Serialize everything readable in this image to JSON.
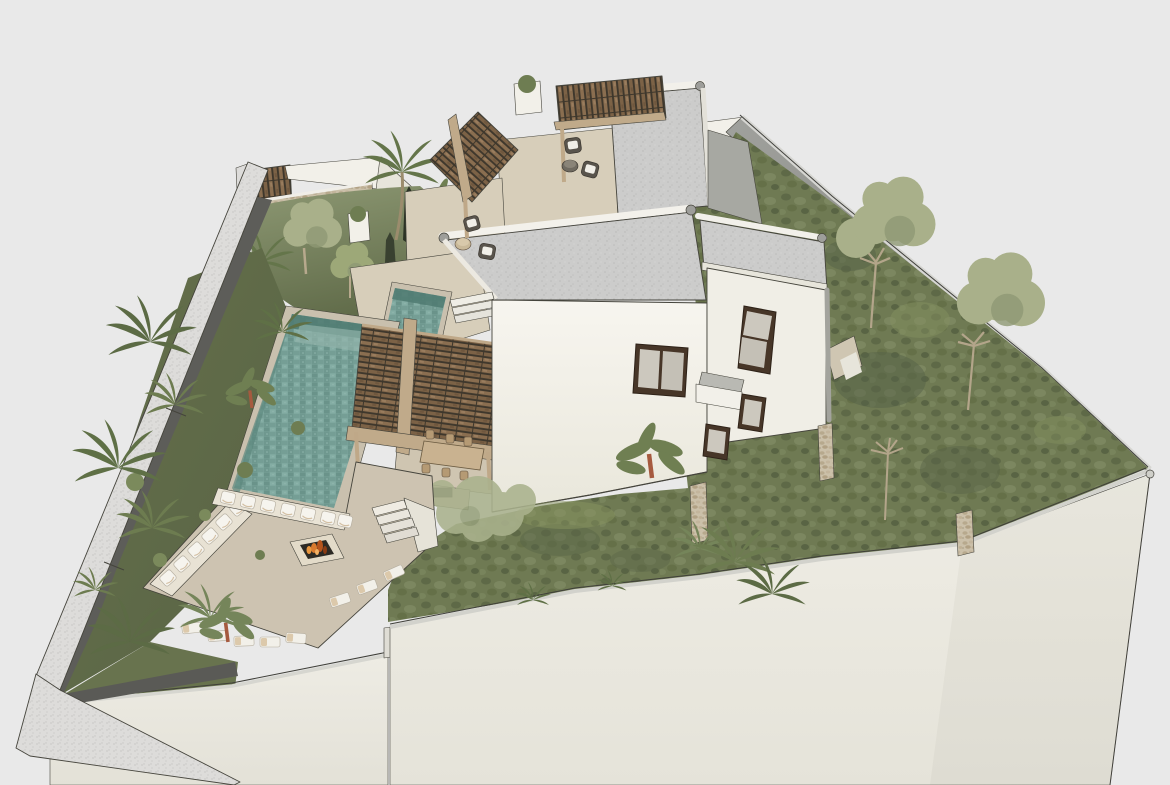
{
  "scene": {
    "title": "Aerial 3D architectural rendering of a modern villa plot with pool, pergolas and terraced gardens",
    "type": "architectural-3d-render",
    "projection": "aerial perspective (SketchUp style)",
    "background": "#e9e9e9",
    "areas": {
      "plot": "irregular walled hillside plot on a raised platform",
      "main_villa": "white flat-roof two-storey house with speckled concrete roof and dark timber-framed windows",
      "side_villa": "white annex volume with tall narrow window, small window and balcony",
      "rear_volume": "taller rear volume with parapet roof and grey side walls",
      "main_pool": "large green-tiled swimming pool with dark inner walls",
      "lap_pool": "narrow connecting upper pool",
      "sunken_lounge": "square lounge terrace with perimeter benches, white cushions, sun loungers and central fire pit with burning logs",
      "dining_pergola": "timber slat pergola over outdoor dining table and outdoor kitchen with grill",
      "walkway_pergola": "timber slat pergola over stepped garden walkway with wicker armchairs",
      "roof_pergola": "rooftop pergola with two wicker armchairs and round table",
      "gardens": "terraced olive-green lawns with sage trees, palms, cypresses and banana plants",
      "boundary": "grey perimeter walls following the sloping terrain, with stone wall section and slatted gate roof at top left",
      "retaining_walls": "tall cream retaining wall faces along the lower street side"
    },
    "counts": {
      "dining_chairs": 6,
      "terrace_armchair_sets": 2,
      "bench_cushions": 13,
      "sun_loungers": 8,
      "lawn_trees": 3,
      "palm_plants": 12,
      "banana_plants": 3,
      "planters": 2,
      "stairs_flights": 2
    }
  },
  "colors": {
    "background": "#e9e9e9",
    "white_wall": "#f2f0e9",
    "white_wall_shade": "#e7e5db",
    "parapet_white": "#f3f1eb",
    "pole_grey": "#9e9e9a",
    "roof_speckle": "#cccccb",
    "roof_grey_plane": "#a7a8a2",
    "terrace": "#d7ceba",
    "dining_floor": "#cfc5b1",
    "lounge_floor": "#cdc3b1",
    "coping": "#c9c0ae",
    "pool_water": "#7aa39a",
    "pool_shadow": "#4f7a71",
    "pergola_slat": "#8a6e50",
    "pergola_gap": "#3e372c",
    "pergola_beam": "#c0aa8a",
    "lawn": "#6f7a53",
    "lawn_dark": "#566147",
    "tree_sage": "#a9b08a",
    "palm_green": "#6d7c50",
    "palm_dark": "#5c6b45",
    "trunk": "#b3a58a",
    "banana_trunk": "#a65a3f",
    "stone": "#cbc0a9",
    "boundary_wall_top": "#dddcda",
    "boundary_wall_face": "#8e8f8b",
    "path_dark": "#5d5d59",
    "fire_orange": "#d97a2e",
    "fire_dark": "#8a3c14",
    "cushion_white": "#f6f4ee",
    "cushion_tan": "#d3bfa3",
    "wicker": "#59544c",
    "window_frame": "#473628",
    "window_glass": "#ccc8be",
    "table_wood": "#c9b290",
    "retaining_face": "#eae8e0"
  }
}
